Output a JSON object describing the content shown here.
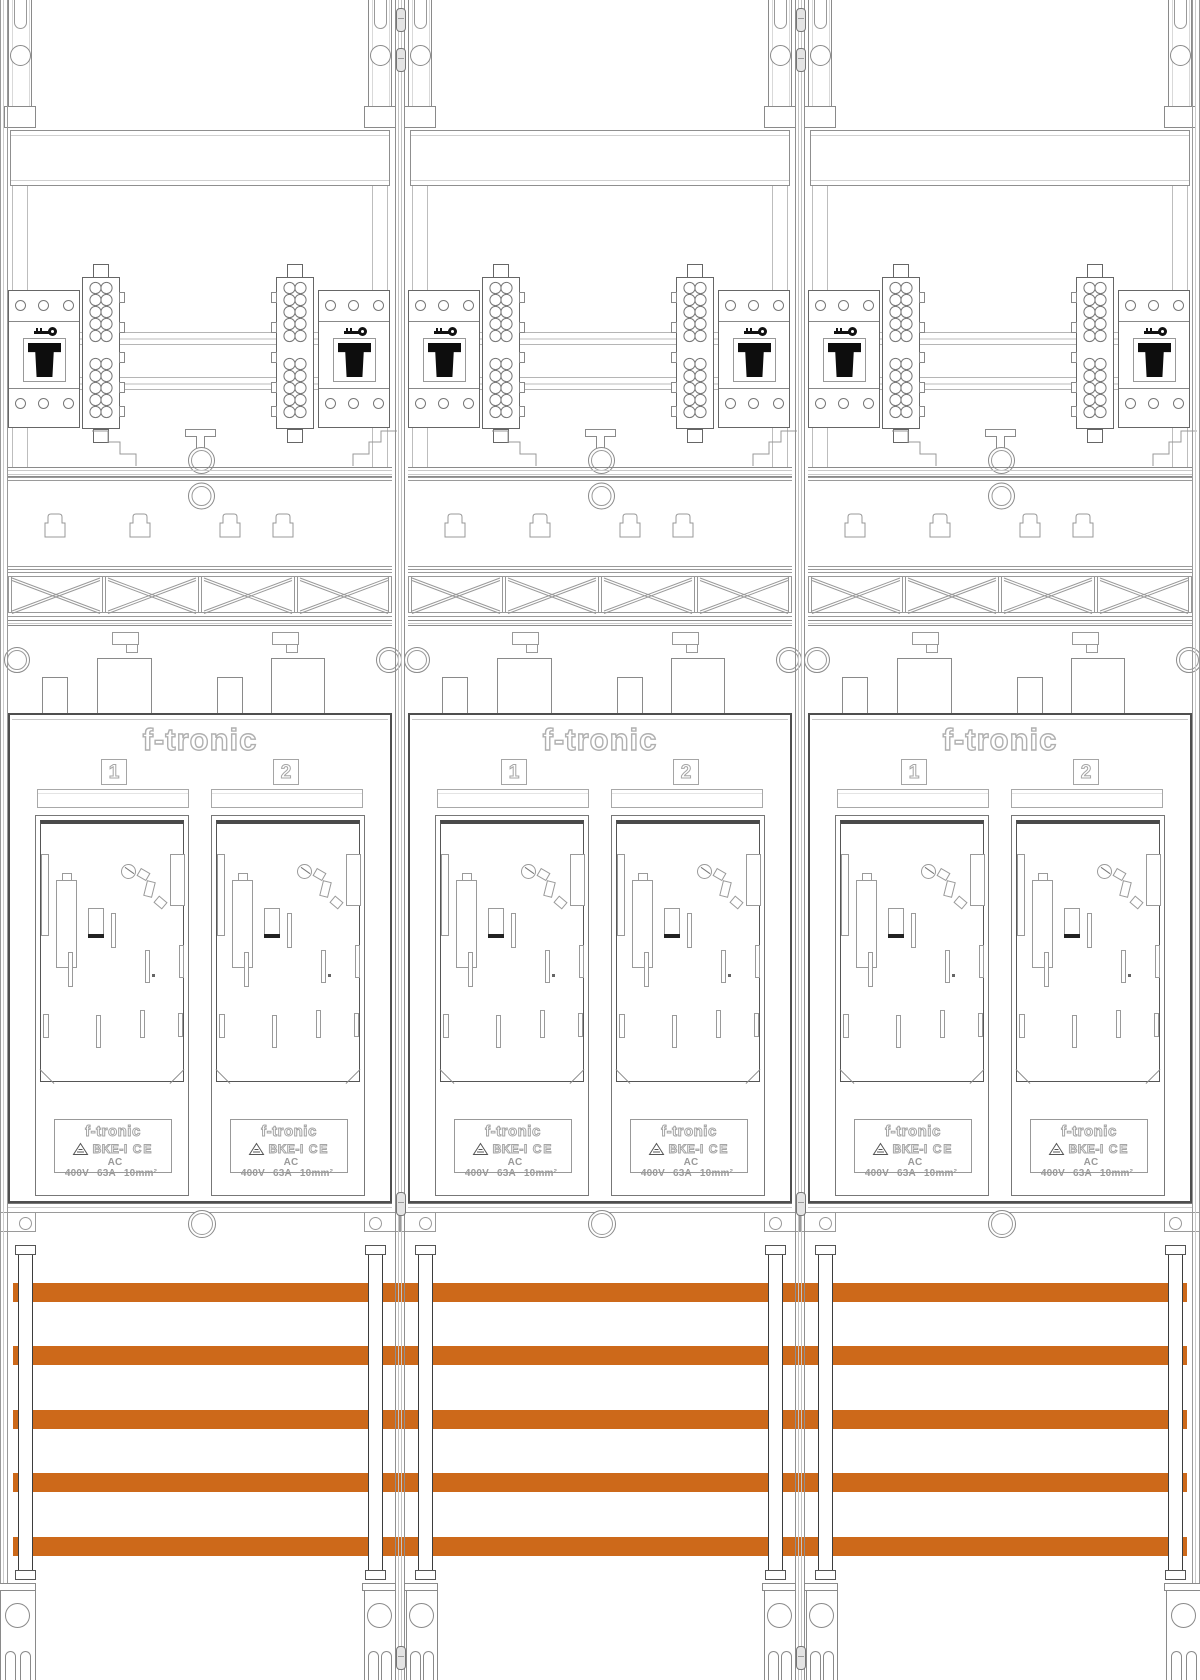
{
  "brand": "f-tronic",
  "panel_count": 3,
  "slots": [
    {
      "number": "1"
    },
    {
      "number": "2"
    }
  ],
  "device_label": {
    "brand": "f-tronic",
    "model": "BKE-I",
    "ce": "CE",
    "voltage": "AC 400V",
    "current": "63A",
    "cross_section": "10mm²"
  },
  "busbars": {
    "count": 5
  },
  "colors": {
    "busbar": "#CD691A"
  }
}
